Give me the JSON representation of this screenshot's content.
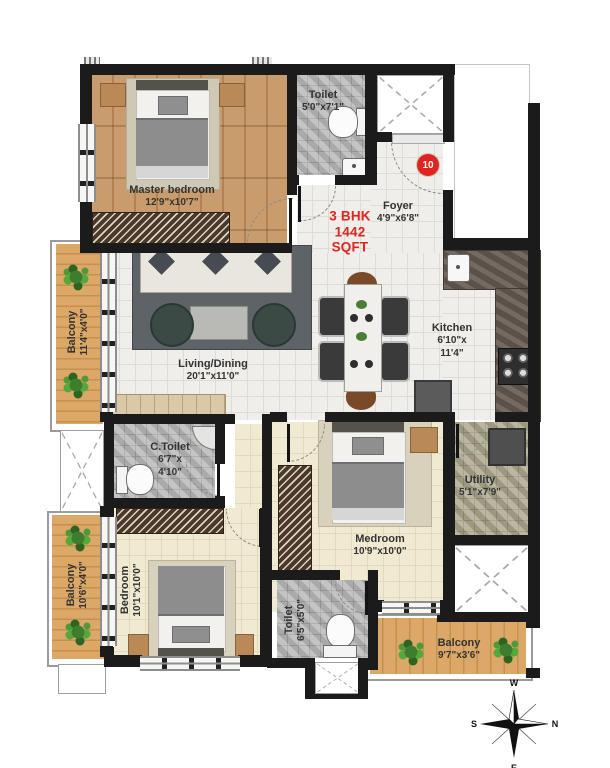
{
  "title_block": {
    "line1": "3 BHK",
    "line2": "1442",
    "line3": "SQFT"
  },
  "entrance": {
    "unit_marker": "10"
  },
  "rooms": [
    {
      "name": "Master bedroom",
      "dims": "12'9\"x10'7\""
    },
    {
      "name": "Toilet",
      "dims": "5'0\"x7'1\""
    },
    {
      "name": "Foyer",
      "dims": "4'9\"x6'8\""
    },
    {
      "name": "Living/Dining",
      "dims": "20'1\"x11'0\""
    },
    {
      "name": "Kitchen",
      "dims": "6'10\"x",
      "dims2": "11'4\""
    },
    {
      "name": "Balcony",
      "dims": "11'4\"x4'0\""
    },
    {
      "name": "C.Toilet",
      "dims": "6'7\"x",
      "dims2": "4'10\""
    },
    {
      "name": "Bedroom",
      "dims": "10'1\"x10'0\""
    },
    {
      "name": "Balcony",
      "dims": "10'6\"x4'0\""
    },
    {
      "name": "Medroom",
      "dims": "10'9\"x10'0\""
    },
    {
      "name": "Toilet",
      "dims": "6'5\"x5'0\""
    },
    {
      "name": "Utility",
      "dims": "5'1\"x7'9\""
    },
    {
      "name": "Balcony",
      "dims": "9'7\"x3'6\""
    }
  ],
  "compass": {
    "top": "W",
    "right": "N",
    "bottom": "E",
    "left": "S"
  },
  "colors": {
    "accent_red": "#e02420",
    "wall_black": "#1b1b1b",
    "wood_floor": "#c89c6c",
    "balcony_wood": "#d7a263",
    "tile_floor": "#efeeea",
    "bedroom_floor": "#f1ead2",
    "toilet_tile": "#b4b4b4",
    "utility_tile": "#a9a48a",
    "counter_granite": "#6b6158",
    "label_text": "#333333"
  }
}
